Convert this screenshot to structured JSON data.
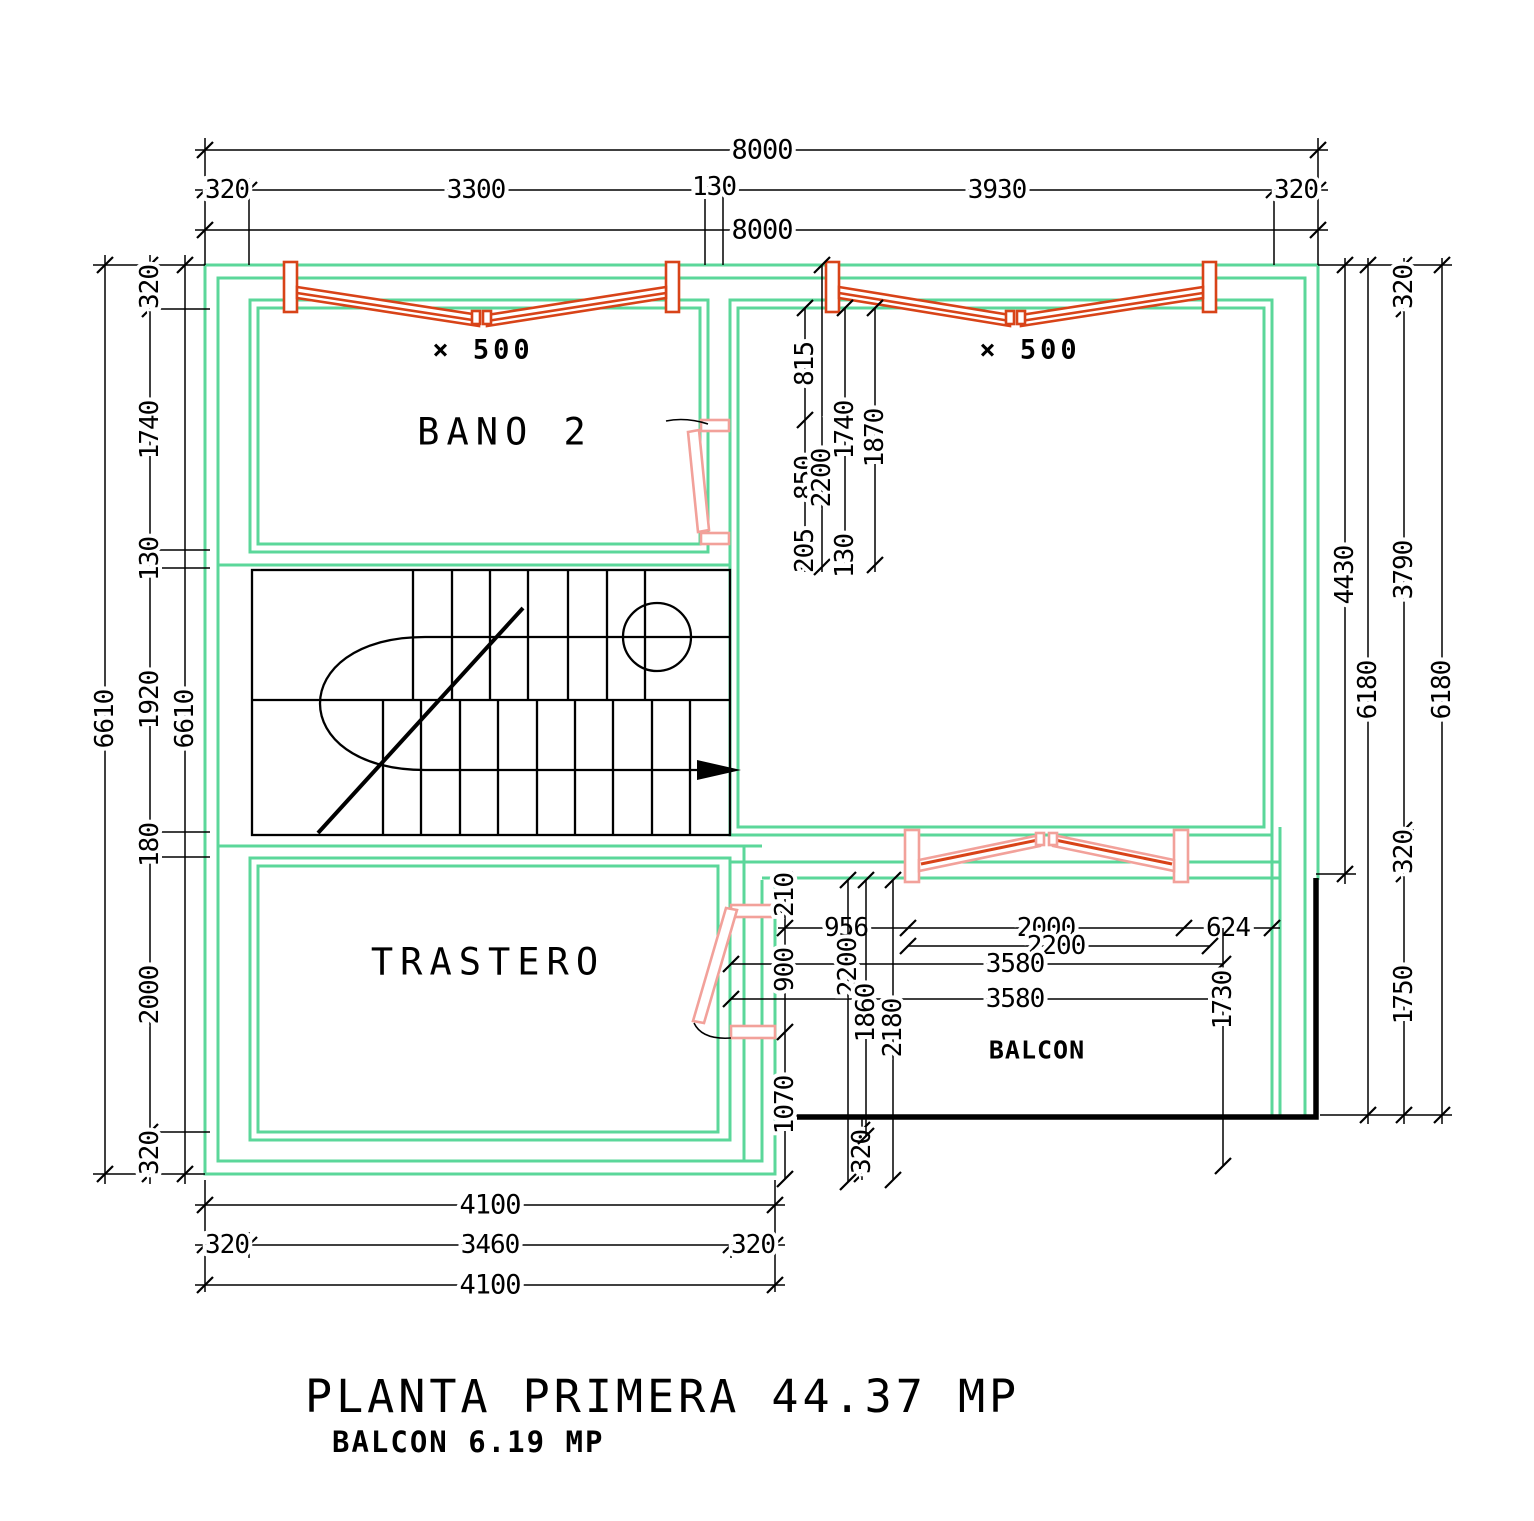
{
  "title": {
    "line1": "PLANTA PRIMERA 44.37 MP",
    "line2": "BALCON 6.19 MP"
  },
  "rooms": {
    "bathroom": "BANO 2",
    "storage": "TRASTERO",
    "balcony": "BALCON"
  },
  "windows": {
    "left_label": "× 500",
    "right_label": "× 500"
  },
  "colors": {
    "wall_green": "#5bd79a",
    "window_red": "#d84318",
    "door_pink": "#f2a19a",
    "drawing_black": "#000000"
  },
  "dims": {
    "top": {
      "overall_1": "8000",
      "wall_left": "320",
      "bath_width": "3300",
      "mid_wall": "130",
      "room_width": "3930",
      "wall_right": "320",
      "overall_2": "8000"
    },
    "left": {
      "overall_1": "6610",
      "wall_top": "320",
      "bath": "1740",
      "wall_mid": "130",
      "stair": "1920",
      "wall_low": "180",
      "storage": "2000",
      "wall_bottom": "320",
      "overall_2": "6610"
    },
    "right": {
      "upper": "4430",
      "overall_1": "6180",
      "wall_top": "320",
      "room": "3790",
      "wall_mid": "320",
      "balcony": "1750",
      "overall_2": "6180"
    },
    "mid": {
      "a815": "815",
      "b850": "850",
      "c205": "205",
      "d2200": "2200",
      "e1740": "1740",
      "f130": "130",
      "g1870": "1870"
    },
    "balcony": {
      "h956": "956",
      "h2000": "2000",
      "h624": "624",
      "h2200": "2200",
      "h3580a": "3580",
      "h3580b": "3580",
      "v210": "210",
      "v900": "900",
      "v1070": "1070",
      "v320": "320",
      "v2200": "2200",
      "v1860": "1860",
      "v2180": "2180",
      "v1730": "1730"
    },
    "bottom": {
      "overall_1": "4100",
      "wall_left": "320",
      "storage_width": "3460",
      "wall_right": "320",
      "overall_2": "4100"
    }
  }
}
